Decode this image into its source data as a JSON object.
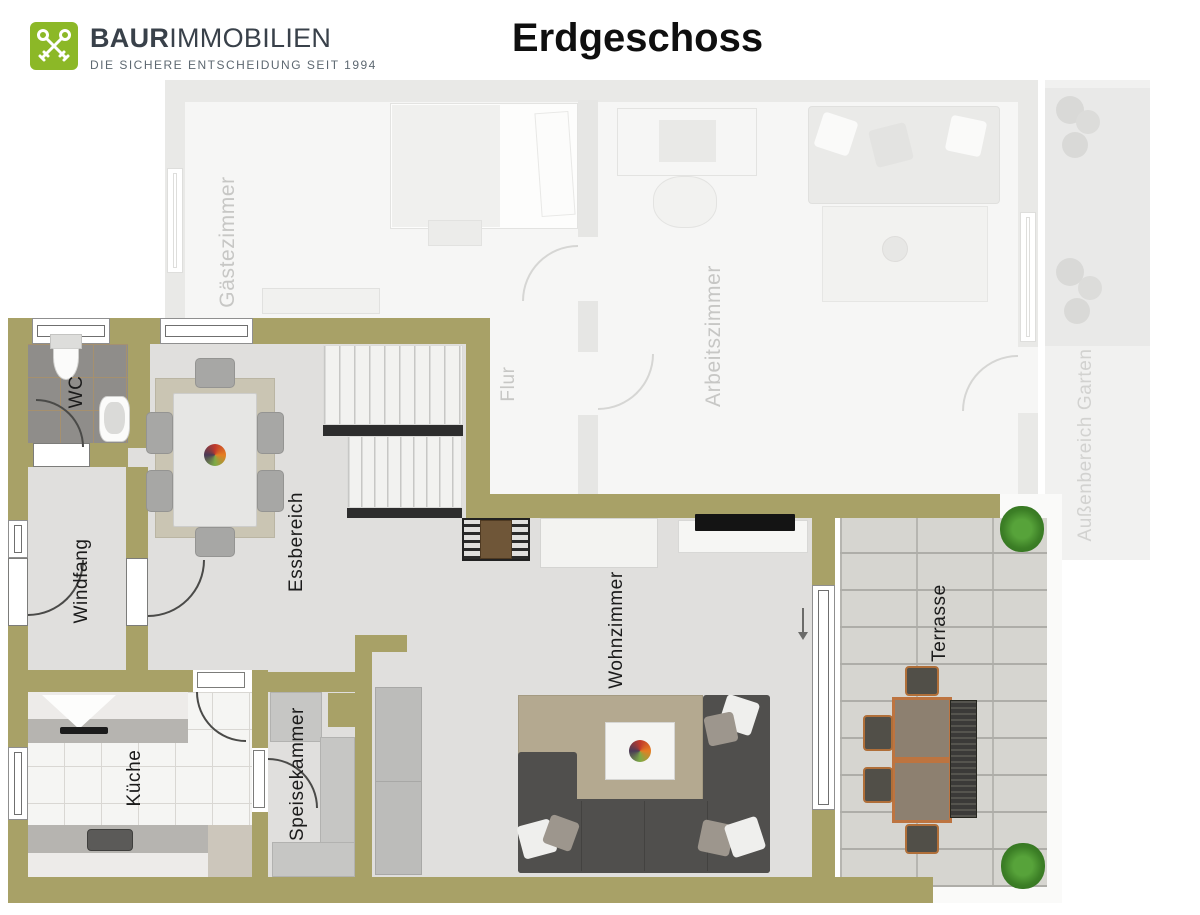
{
  "header": {
    "brand": {
      "bold": "BAUR",
      "regular": "IMMOBILIEN",
      "tagline": "DIE SICHERE ENTSCHEIDUNG SEIT 1994"
    },
    "title": "Erdgeschoss"
  },
  "floorplan": {
    "labels": {
      "wc": "WC",
      "windfang": "Windfang",
      "essbereich": "Essbereich",
      "kueche": "Küche",
      "speisekammer": "Speisekammer",
      "wohnzimmer": "Wohnzimmer",
      "terrasse": "Terrasse",
      "gaestezimmer": "Gästezimmer",
      "flur": "Flur",
      "arbeitszimmer": "Arbeitszimmer",
      "aussenbereich_garten": "Außenbereich Garten"
    },
    "colors": {
      "wall": "#a8a167",
      "brand_green": "#8cb827",
      "active_floor": "#e0dfdd",
      "faded_floor": "#f6f6f5",
      "terrace_paver": "#d6d5d0",
      "sofa_gray": "#504f4d",
      "stair_marking": "#2d2d2d"
    }
  }
}
